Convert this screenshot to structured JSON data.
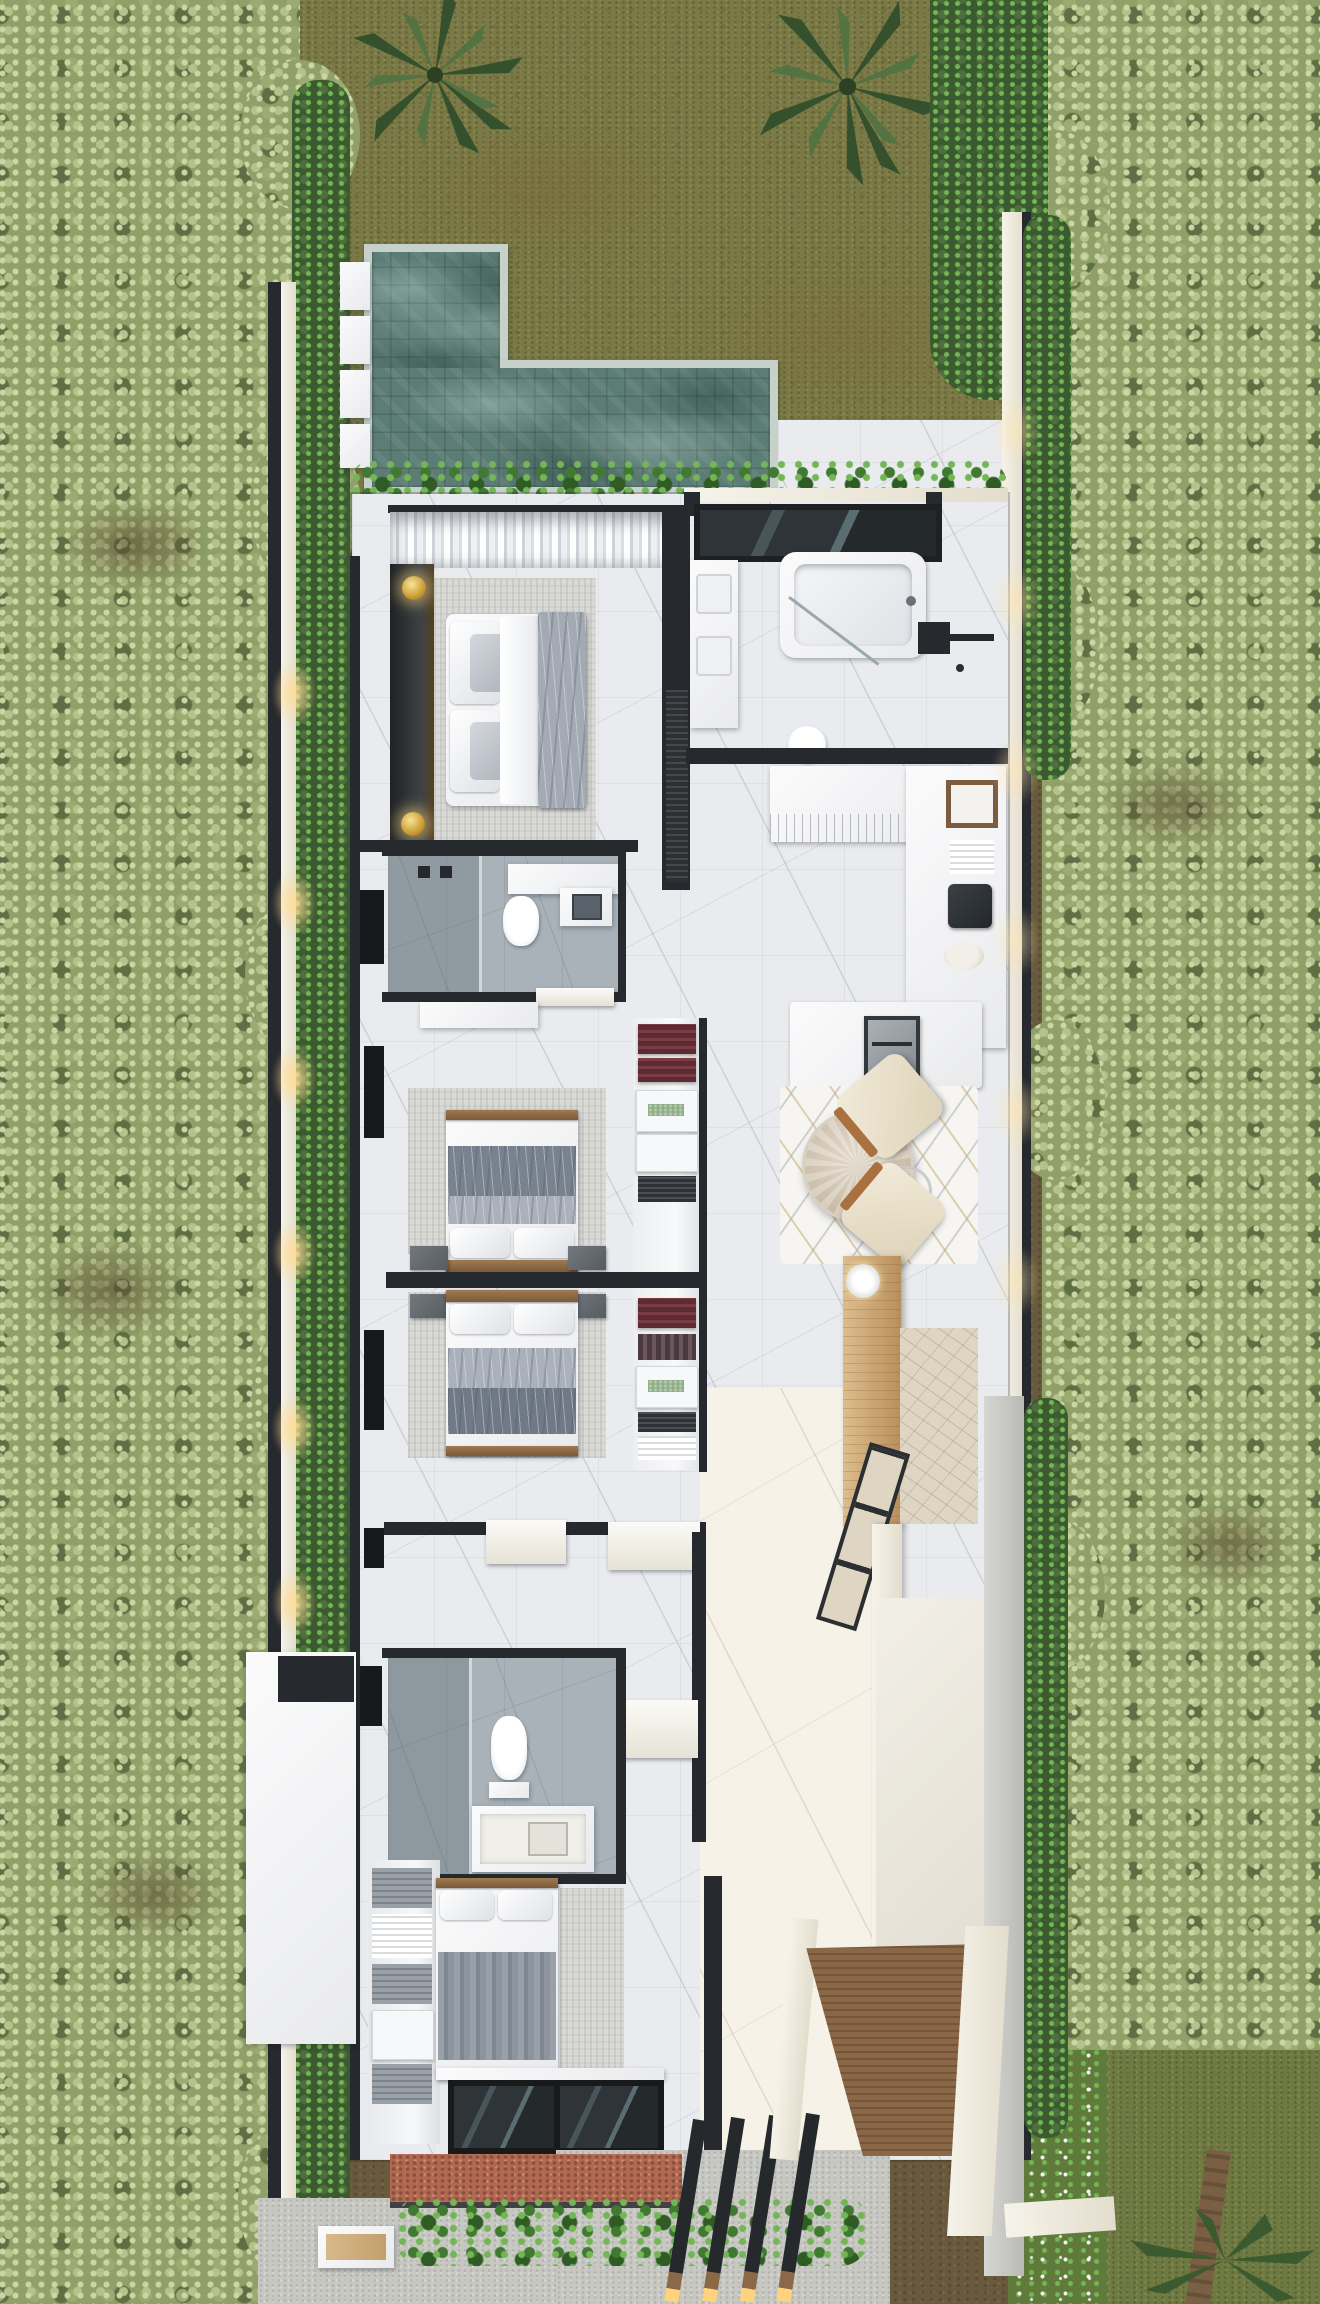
{
  "scene": {
    "title": "Top-down 3D render of a tropical villa floor plan with pool and garden",
    "type": "architectural-aerial-render",
    "view": "top-down"
  },
  "palette": {
    "dirt": "#6a5a3d",
    "canopy": "#b5c28c",
    "canopyLight": "#cbd6a4",
    "canopyMid": "#9cab72",
    "canopyDark": "#8fa068",
    "canopyShadow": "#5f6f44",
    "hedge": "#4e6f3d",
    "hedgeDark": "#3c5a2f",
    "grass": "#7b7a46",
    "lawnB": "#6f7a42",
    "meadow": "#5f7a3a",
    "poolWater": "#5c7d76",
    "coping": "#c6d2c9",
    "marble": "#e9ebee",
    "marbleWarm": "#f6f2e8",
    "wallDark": "#26292d",
    "grayTile": "#a9b2b9",
    "rug": "#d9d9d6",
    "wood": "#96714c",
    "woodLight": "#dcbd8c",
    "woodDeck": "#8a6847",
    "gold": "#c9a13b",
    "terracotta": "#b26950",
    "terracottaDark": "#8c5040",
    "concrete": "#c8c8c3",
    "stoneBeige": "#ded5c2",
    "plant": "#3f7a30",
    "plantDark": "#2e5c24",
    "plantLight": "#74b656"
  },
  "site": {
    "left_forest": {
      "label": "dense pale-green tree canopy along west boundary"
    },
    "right_forest": {
      "label": "dense pale-green tree canopy along east boundary"
    },
    "backyard": {
      "label": "olive grass backyard with two palm trees"
    },
    "pool": {
      "label": "L-shaped stone-tiled swimming pool",
      "stepping_pads": 4
    },
    "planting": {
      "label": "monstera hedge between pool and house"
    },
    "boundary": {
      "label": "dark perimeter walls with warm garden uplights",
      "uplights_left": 6,
      "uplights_right": 6
    },
    "entry": {
      "label": "entry court with terracotta mat, hedge, concrete paths and pergola beams",
      "pergola_beams": 4
    },
    "carport": {
      "label": "timber deck ramp between white walls"
    },
    "bottom_lawn": {
      "label": "lawn with flowering meadow strip and palm tree"
    }
  },
  "rooms": {
    "master_bedroom": {
      "label": "master bedroom",
      "furniture": [
        "double bed with gray throw",
        "headboard wall with two gold lamps",
        "sheer curtains",
        "area rug",
        "media wall"
      ]
    },
    "master_bathroom": {
      "label": "master bathroom",
      "furniture": [
        "freestanding bathtub",
        "double vanity",
        "walk-in shower with black fixtures",
        "toilet",
        "dark-framed skylight"
      ]
    },
    "powder_room": {
      "label": "guest bathroom",
      "furniture": [
        "shower",
        "toilet",
        "vanity with vessel sink",
        "sliding door"
      ]
    },
    "kitchen": {
      "label": "kitchen",
      "furniture": [
        "white cabinetry",
        "side counter with tray, towels and coffee maker",
        "island with built-in oven"
      ]
    },
    "dining": {
      "label": "dining area",
      "furniture": [
        "round marble table",
        "glass side table",
        "two cream armchairs",
        "geometric rug"
      ]
    },
    "wardrobe": {
      "label": "walk-in wardrobe shelving",
      "furniture": [
        "folded clothes",
        "drawer boxes",
        "woven green box",
        "plate shelf"
      ]
    },
    "bedroom_2": {
      "label": "bedroom 2",
      "furniture": [
        "double bed",
        "two nightstands",
        "area rug",
        "dresser"
      ]
    },
    "bedroom_3": {
      "label": "bedroom 3",
      "furniture": [
        "double bed",
        "two nightstands",
        "area rug"
      ]
    },
    "bathroom_2": {
      "label": "shared bathroom",
      "furniture": [
        "shower",
        "toilet",
        "vanity"
      ]
    },
    "bedroom_4": {
      "label": "bedroom 4",
      "furniture": [
        "double bed",
        "closet shelving",
        "rug",
        "dark sliding glass wall"
      ]
    },
    "living_hall": {
      "label": "living hall",
      "furniture": [
        "timber console",
        "round ceiling lamp",
        "stone feature panel",
        "dark-framed window wall"
      ]
    },
    "entry_hall": {
      "label": "sunlit entry gallery"
    }
  }
}
